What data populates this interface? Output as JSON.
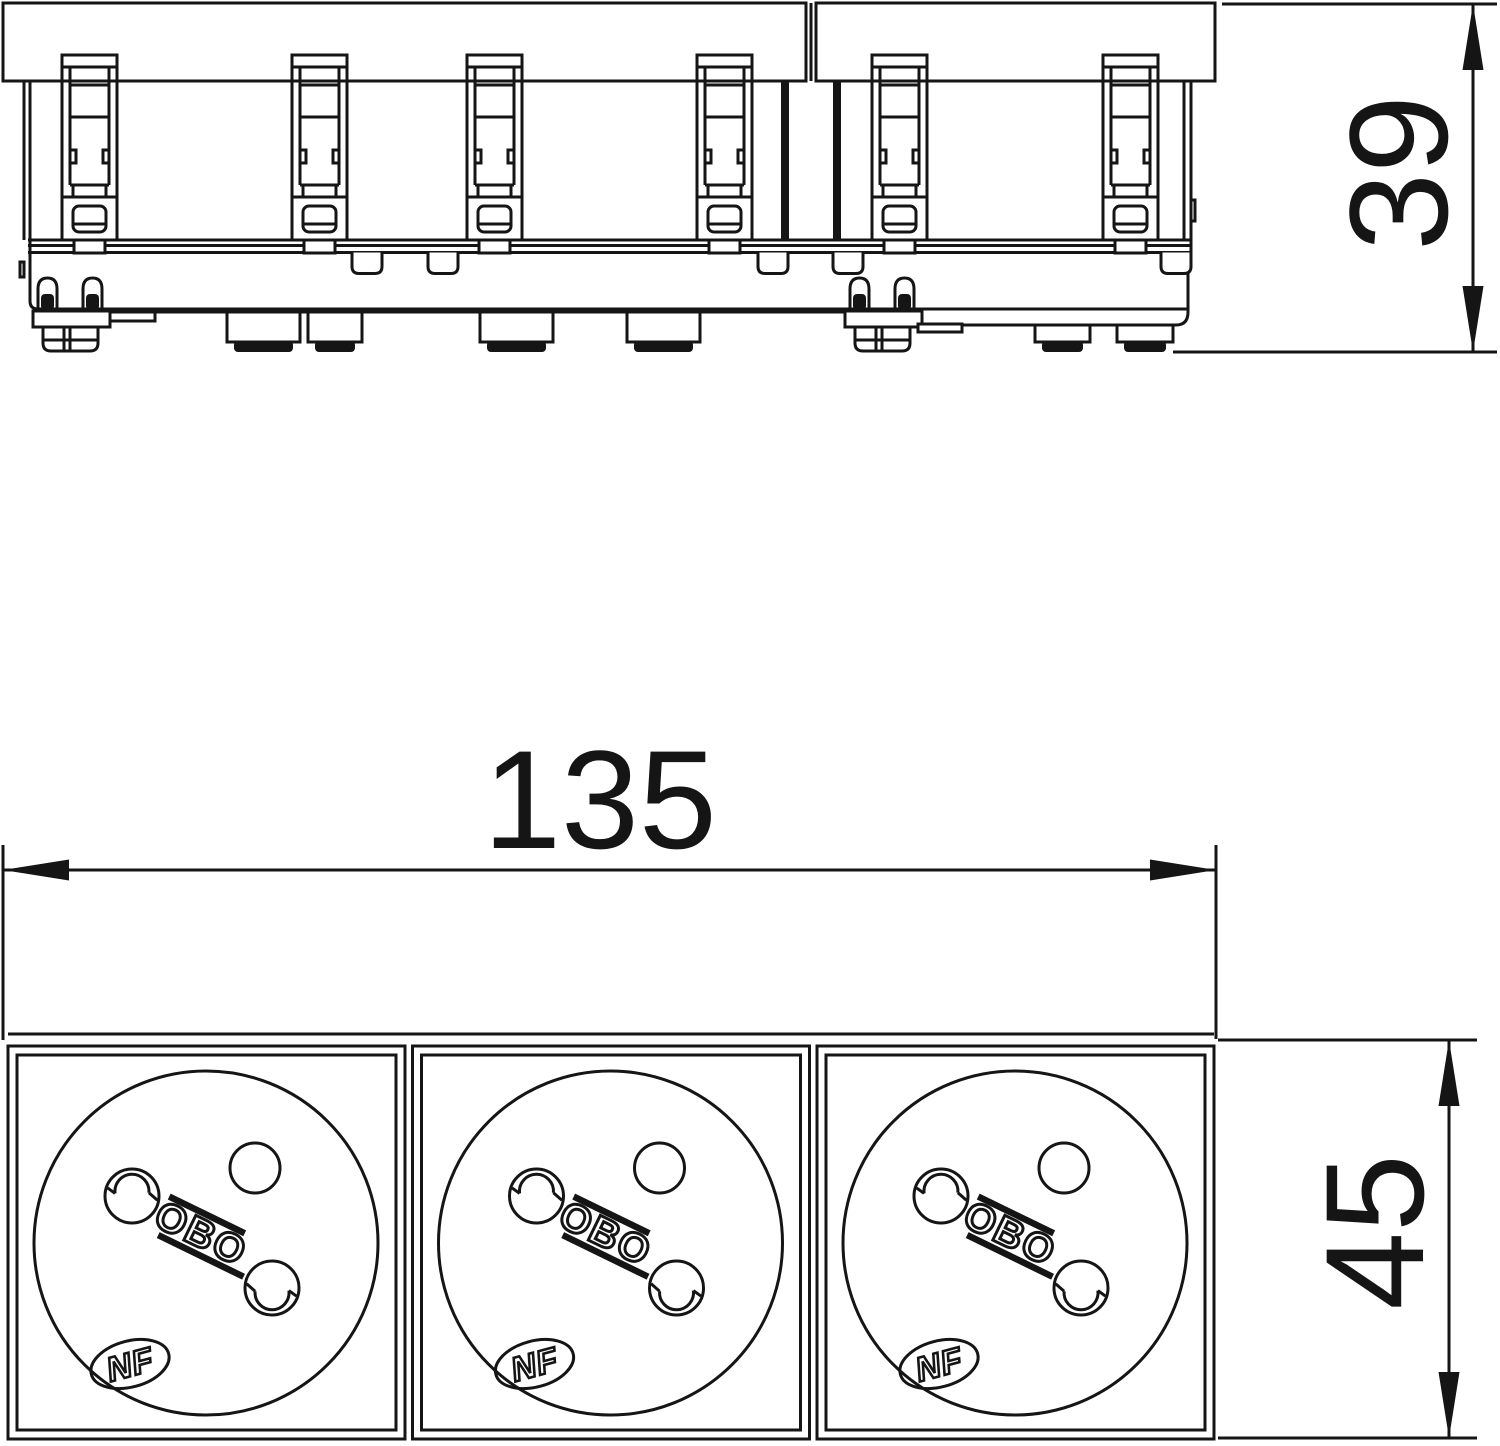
{
  "dimensions": {
    "d39": "39",
    "d135": "135",
    "d45": "45"
  },
  "socket": {
    "brand_label": "OBO",
    "certification_label": "NF",
    "module_count": 3
  },
  "colors": {
    "background": "#ffffff",
    "line": "#151515"
  }
}
